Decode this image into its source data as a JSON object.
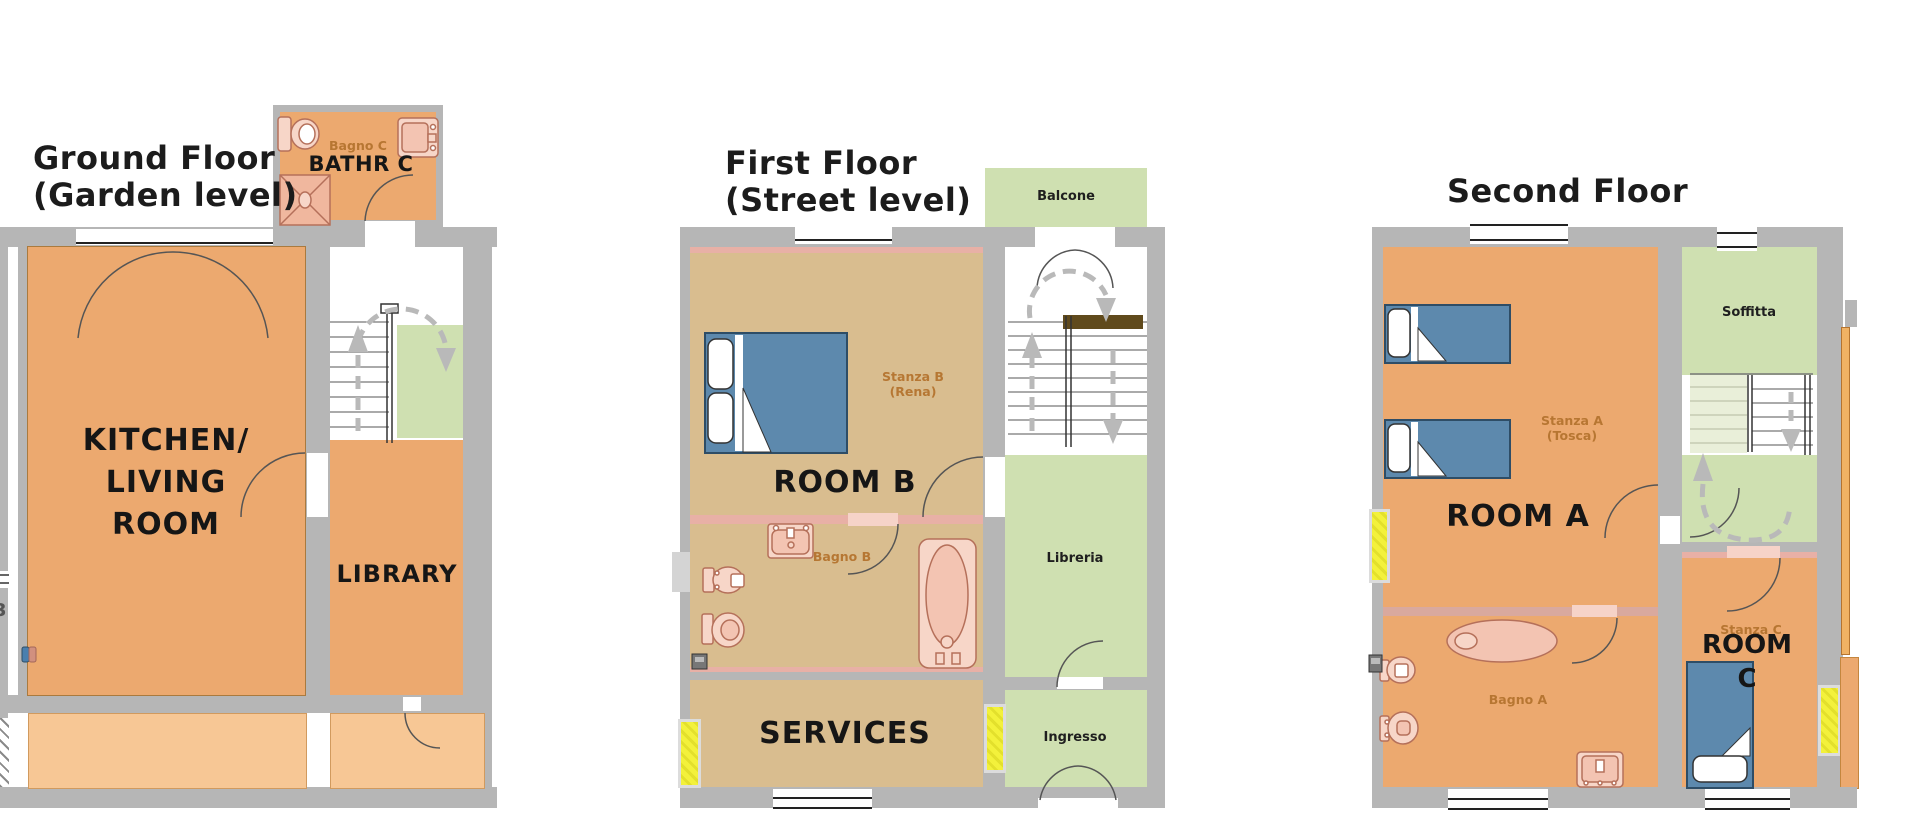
{
  "ground": {
    "title_lines": [
      "Ground Floor",
      "(Garden level)"
    ],
    "bathr_c_label": "BATHR C",
    "bagno_c_label": "Bagno C",
    "kitchen_lines": [
      "KITCHEN/",
      "LIVING",
      "ROOM"
    ],
    "library_label": "LIBRARY",
    "edge_fragment": "3"
  },
  "first": {
    "title_lines": [
      "First Floor",
      "(Street level)"
    ],
    "balcone_label": "Balcone",
    "stanza_b_lines": [
      "Stanza B",
      "(Rena)"
    ],
    "room_b_label": "ROOM B",
    "bagno_b_label": "Bagno B",
    "services_label": "SERVICES",
    "libreria_label": "Libreria",
    "ingresso_label": "Ingresso"
  },
  "second": {
    "title": "Second Floor",
    "soffitta_label": "Soffitta",
    "stanza_a_lines": [
      "Stanza A",
      "(Tosca)"
    ],
    "room_a_label": "ROOM A",
    "bagno_a_label": "Bagno A",
    "stanza_c_label": "Stanza C",
    "room_c_lines": [
      "ROOM",
      "C"
    ]
  },
  "colors": {
    "wall_gray": "#b6b6b6",
    "room_orange": "#eca96f",
    "terrace_light_orange": "#f7c795",
    "first_floor_tan": "#d9bd8f",
    "green_area": "#cfe0b1",
    "bed_blue": "#5d89ad",
    "fixture_pink": "#f7d6c8",
    "radiator_yellow": "#f3f13b",
    "handrail_brown": "#604a1c",
    "dashed_arrow_gray": "#b9b9b9",
    "faint_label_orange": "#b5742f",
    "label_black": "#161616"
  }
}
